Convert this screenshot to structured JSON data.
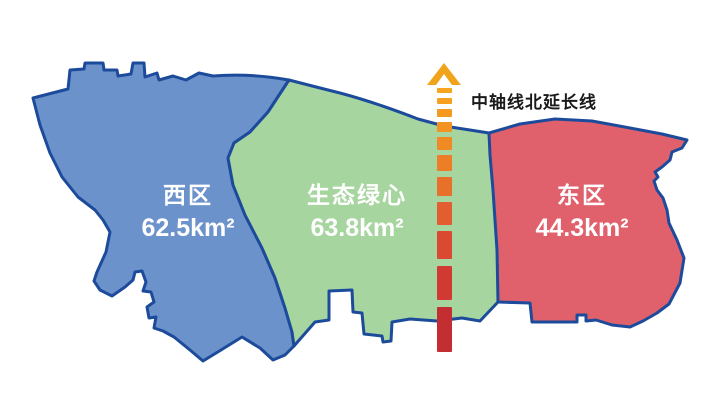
{
  "map": {
    "border_color": "#1d4b9b",
    "background_color": "#ffffff",
    "label_color": "#ffffff"
  },
  "regions": {
    "west": {
      "name": "西区",
      "area": "62.5km²",
      "color": "#6c92cc"
    },
    "center": {
      "name": "生态绿心",
      "area": "63.8km²",
      "color": "#a7d5a0"
    },
    "east": {
      "name": "东区",
      "area": "44.3km²",
      "color": "#e0616c"
    }
  },
  "axis": {
    "label": "中轴线北延长线",
    "label_color": "#1a1a1a",
    "arrow_color": "#f2a31c",
    "dash_x": 437,
    "dash_width": 15,
    "gradient_top_color": "#f6a51c",
    "gradient_bottom_color": "#c22e32",
    "dashes": [
      {
        "y": 88,
        "h": 5,
        "color": "#f6a51c"
      },
      {
        "y": 98,
        "h": 6,
        "color": "#f5a01e"
      },
      {
        "y": 109,
        "h": 8,
        "color": "#f49a20"
      },
      {
        "y": 122,
        "h": 10,
        "color": "#f29322"
      },
      {
        "y": 137,
        "h": 13,
        "color": "#f08a24"
      },
      {
        "y": 155,
        "h": 16,
        "color": "#ed7e27"
      },
      {
        "y": 177,
        "h": 19,
        "color": "#e8702b"
      },
      {
        "y": 202,
        "h": 23,
        "color": "#e25d2f"
      },
      {
        "y": 231,
        "h": 28,
        "color": "#da4a33"
      },
      {
        "y": 266,
        "h": 34,
        "color": "#d13a33"
      },
      {
        "y": 307,
        "h": 45,
        "color": "#c22e32"
      }
    ]
  }
}
